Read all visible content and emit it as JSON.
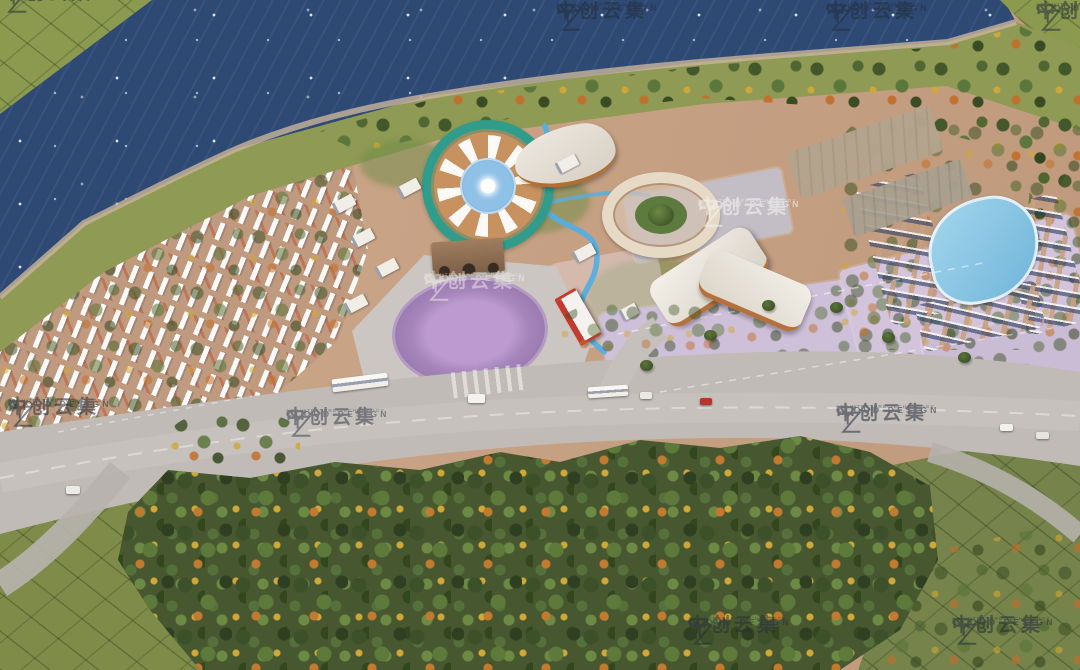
{
  "watermark": {
    "logo_icon": "yz-monogram",
    "brand_cn": "中创云集",
    "brand_en": "CLOUD DESIGN",
    "tagline": "ARCHITECTURE TECHNOLOGY"
  },
  "palette": {
    "lake_water": "#2e4a74",
    "shore_grass": "#8f9a54",
    "terrain_tan": "#c7a184",
    "villa_ground": "#c09a7e",
    "roof_white": "#f2efe9",
    "roof_red": "#c0512f",
    "road_gray": "#c1bbb7",
    "parking_lavender": "#cfc0da",
    "plaza_purple": "#b793c9",
    "track_teal": "#2f9c8c",
    "pool_blue": "#8ac6e2",
    "stream_blue": "#57aede",
    "forest_green": "#47572f",
    "field_olive": "#7f8c49",
    "autumn_orange": "#c2702c",
    "accent_red": "#c43a2e"
  }
}
